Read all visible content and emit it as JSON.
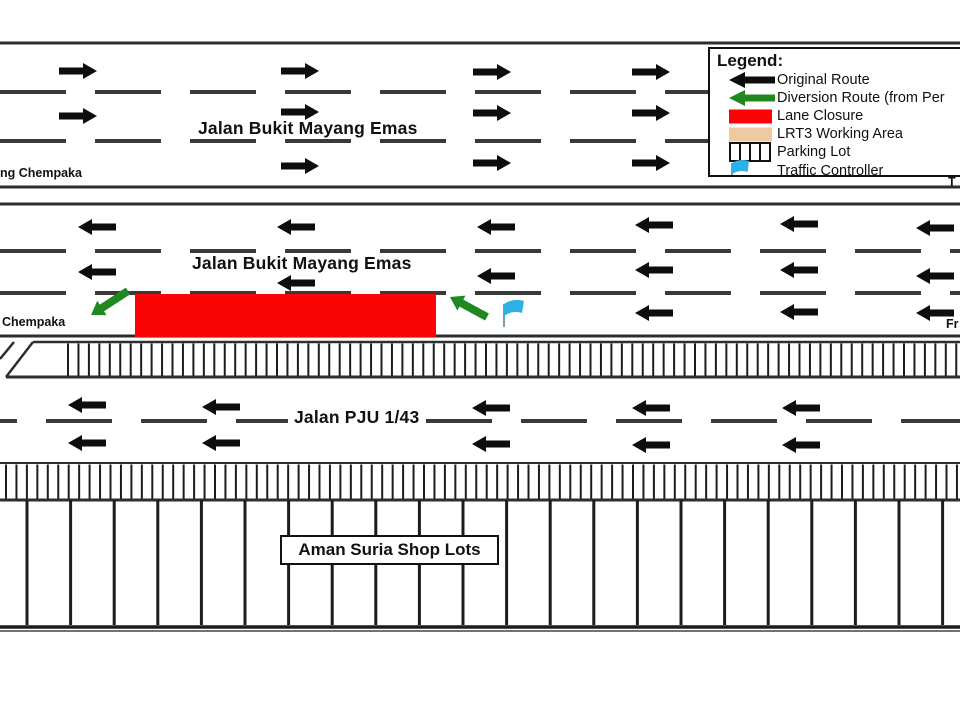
{
  "colors": {
    "ink": "#111111",
    "road_line": "#2e2e2e",
    "lane_dash": "#3a3a3a",
    "arrow_black": "#0d0d0d",
    "diversion_green": "#218821",
    "closure_red": "#fa0505",
    "lrt3_tan": "#eec9a2",
    "flag_blue": "#2cb0e6",
    "hatch": "#1c1c1c"
  },
  "legend": {
    "title": "Legend:",
    "items": [
      {
        "icon": "original-route-arrow-icon",
        "shape": "arrow",
        "color": "#0d0d0d",
        "label": "Original Route"
      },
      {
        "icon": "diversion-route-arrow-icon",
        "shape": "arrow",
        "color": "#218821",
        "label": "Diversion Route (from Per"
      },
      {
        "icon": "lane-closure-swatch-icon",
        "shape": "rect",
        "color": "#fa0505",
        "label": "Lane Closure"
      },
      {
        "icon": "lrt3-working-area-swatch-icon",
        "shape": "rect",
        "color": "#eec9a2",
        "label": "LRT3 Working Area"
      },
      {
        "icon": "parking-lot-icon",
        "shape": "parking",
        "color": "#111111",
        "label": "Parking Lot"
      },
      {
        "icon": "traffic-controller-flag-icon",
        "shape": "flag",
        "color": "#2cb0e6",
        "label": "Traffic Controller"
      }
    ]
  },
  "labels": {
    "road_top": "Jalan Bukit Mayang Emas",
    "road_middle": "Jalan Bukit Mayang Emas",
    "road_pju": "Jalan PJU 1/43",
    "shop_lots": "Aman Suria Shop Lots",
    "edge_top_left": "ng Chempaka",
    "edge_middle_left": "Chempaka",
    "edge_top_right": "T",
    "edge_middle_right": "Fr"
  },
  "diagram": {
    "width": 960,
    "height": 720,
    "roads": {
      "top": {
        "border_y": [
          43,
          187
        ],
        "dash_y": [
          90,
          139
        ],
        "arrow_dir": "right",
        "arrow_cols": [
          {
            "x": 59,
            "rows": [
              71,
              116
            ]
          },
          {
            "x": 281,
            "rows": [
              71,
              112,
              166
            ]
          },
          {
            "x": 473,
            "rows": [
              72,
              113,
              163
            ]
          },
          {
            "x": 632,
            "rows": [
              72,
              113,
              163
            ]
          }
        ]
      },
      "middle": {
        "border_y": [
          204,
          336
        ],
        "dash_y": [
          249,
          291
        ],
        "arrow_dir": "left",
        "arrow_cols": [
          {
            "x": 78,
            "rows": [
              227,
              272
            ]
          },
          {
            "x": 277,
            "rows": [
              227,
              283
            ]
          },
          {
            "x": 477,
            "rows": [
              227,
              276
            ]
          },
          {
            "x": 635,
            "rows": [
              225,
              270,
              313
            ]
          },
          {
            "x": 780,
            "rows": [
              224,
              270,
              312
            ]
          },
          {
            "x": 916,
            "rows": [
              228,
              276,
              313
            ]
          }
        ]
      },
      "pju": {
        "dash_y": 421,
        "dash_offset": 49,
        "arrow_dir": "left",
        "arrow_cols": [
          {
            "x": 68,
            "rows": [
              405,
              443
            ]
          },
          {
            "x": 202,
            "rows": [
              407,
              443
            ]
          },
          {
            "x": 472,
            "rows": [
              408,
              444
            ]
          },
          {
            "x": 632,
            "rows": [
              408,
              445
            ]
          },
          {
            "x": 782,
            "rows": [
              408,
              445
            ]
          }
        ]
      }
    },
    "closure": {
      "x": 135,
      "y": 294,
      "w": 301,
      "h": 43
    },
    "diversion_arrows": [
      {
        "tail": [
          128,
          291
        ],
        "head": [
          91,
          315
        ]
      },
      {
        "tail": [
          487,
          317
        ],
        "head": [
          450,
          297
        ]
      }
    ],
    "traffic_controller": {
      "x": 504,
      "y": 303
    },
    "parking_strips": [
      {
        "top": 342,
        "bottom": 377,
        "hatch_start": 68,
        "hatch_end": 958,
        "spacing": 10.45,
        "slant": [
          [
            33,
            342
          ],
          [
            6,
            377
          ]
        ],
        "curb": [
          [
            14,
            342
          ],
          [
            0,
            359
          ]
        ]
      },
      {
        "top": 463,
        "bottom": 500,
        "hatch_start": 6,
        "hatch_end": 958,
        "spacing": 10.45
      }
    ],
    "shops": {
      "top": 500,
      "bottom": 625,
      "divider_start": 27,
      "divider_spacing": 43.6,
      "bottom_line": 627,
      "baseline2": 631
    }
  }
}
